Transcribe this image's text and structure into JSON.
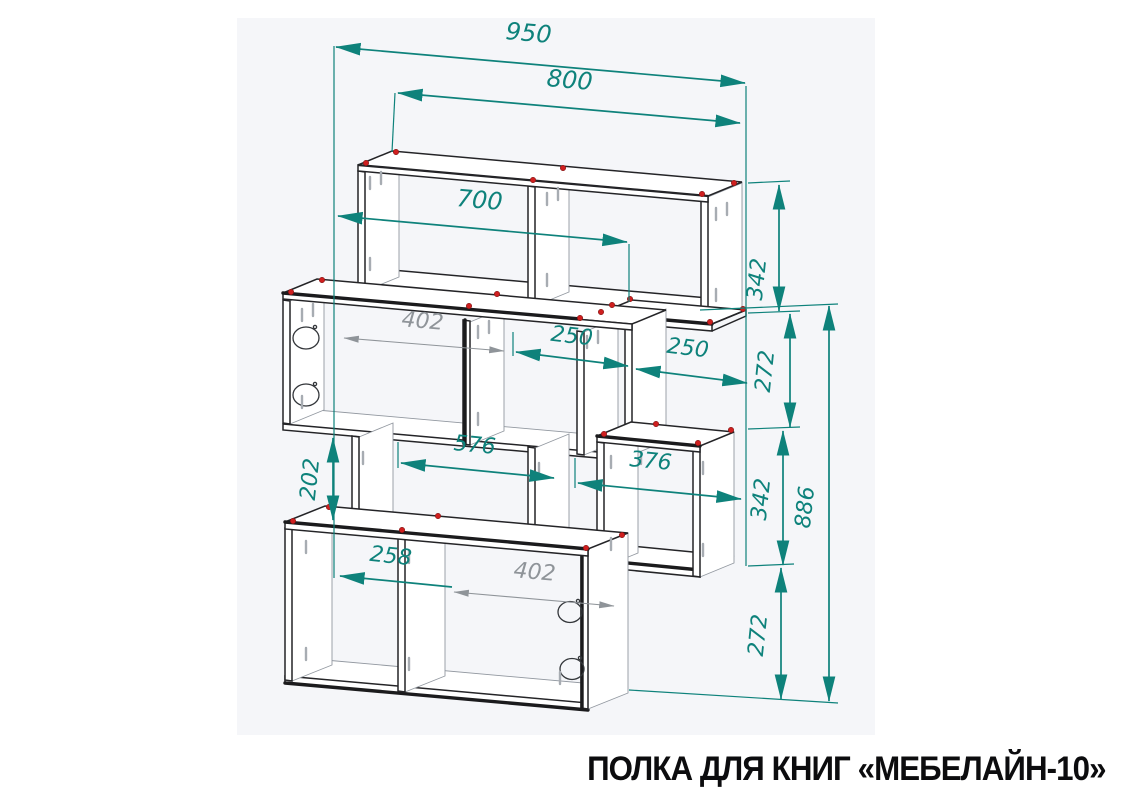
{
  "title": "ПОЛКА ДЛЯ КНИГ «МЕБЕЛАЙН-10»",
  "drawing": {
    "kind": "furniture assembly dimension drawing",
    "product": "book shelf",
    "dims": {
      "overall_width": "950",
      "shelf_width": "800",
      "inner_width": "700",
      "mid_left_section": "402",
      "mid_center_section": "250",
      "mid_right_section": "250",
      "lower_left_span": "576",
      "lower_right_span": "376",
      "bottom_left_section": "258",
      "bottom_right_section": "402",
      "left_gap": "202",
      "top_height": "342",
      "upper_gap": "272",
      "lower_height": "342",
      "bottom_gap": "272",
      "overall_height": "886"
    },
    "colors": {
      "dimension": "#0e827b",
      "secondary_dimension": "#8f9499",
      "outline": "#1b1b1d",
      "fastener_marker": "#cf1f1f",
      "canvas": "#f5f6f9"
    }
  }
}
